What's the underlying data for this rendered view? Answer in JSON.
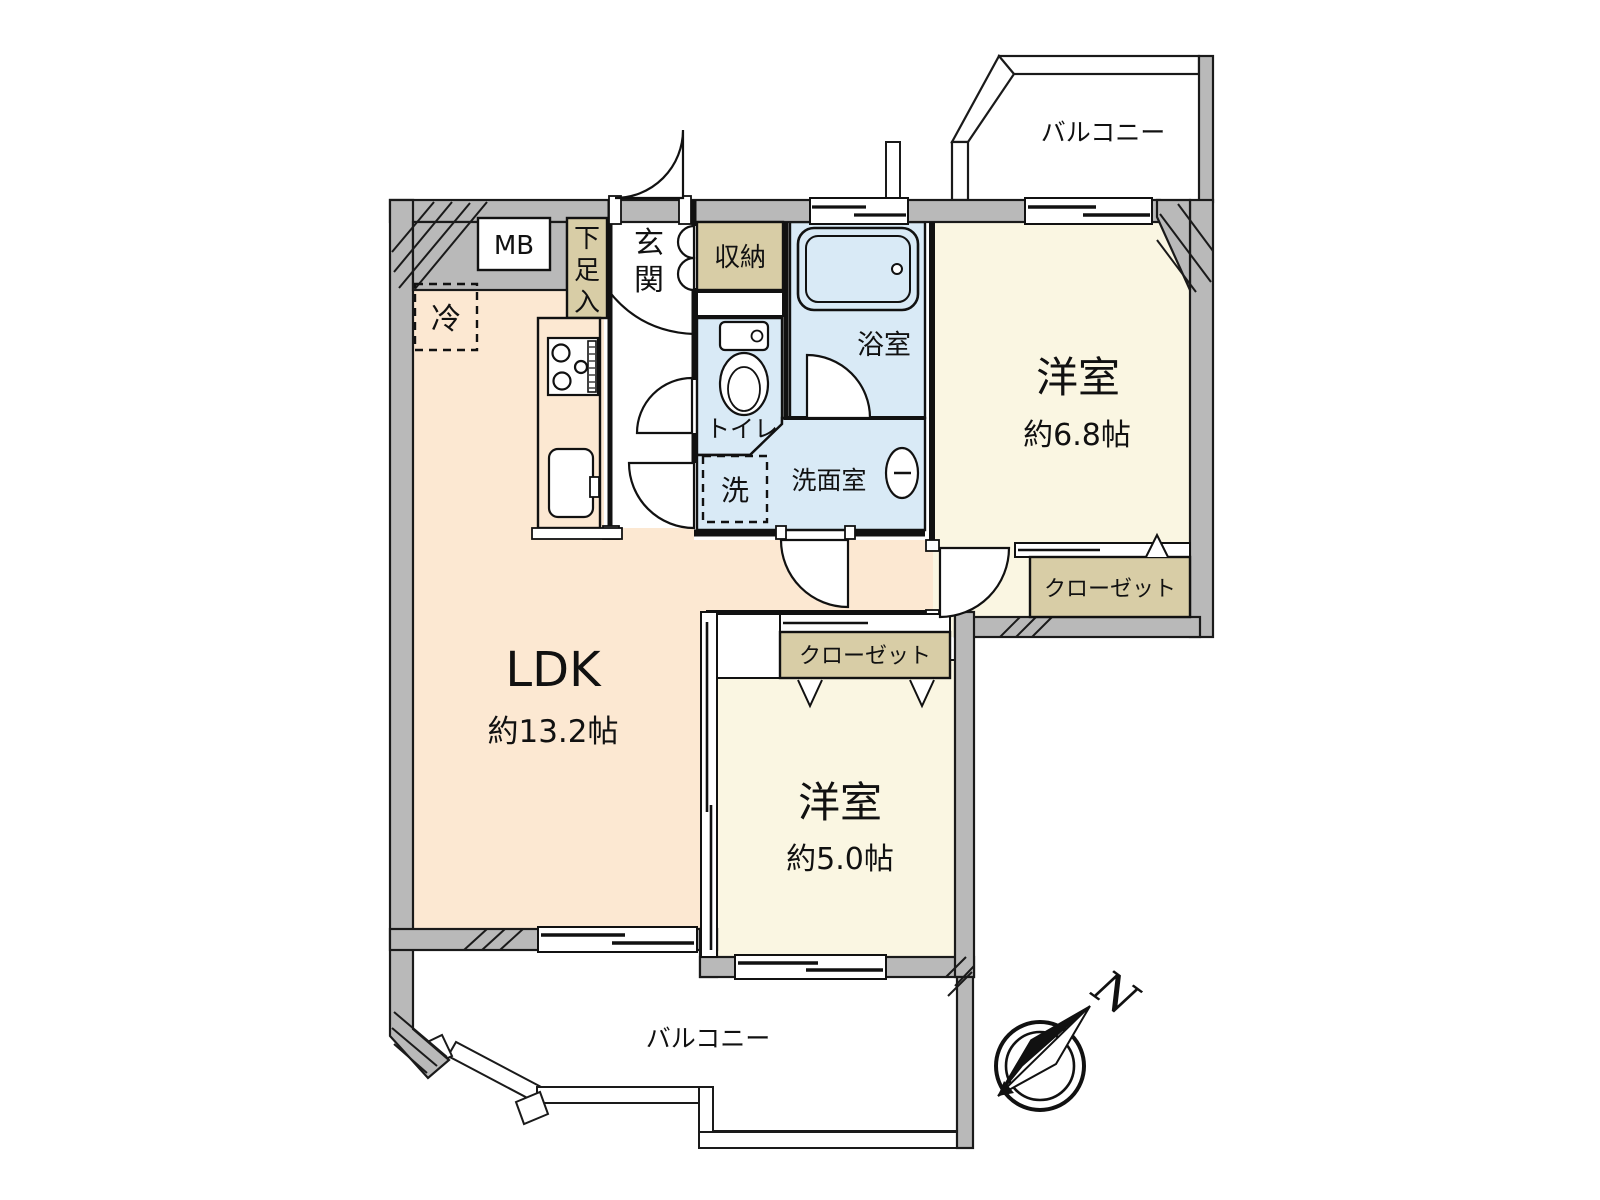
{
  "floorplan": {
    "labels": {
      "balcony_top": "バルコニー",
      "balcony_bottom": "バルコニー",
      "room_68_name": "洋室",
      "room_68_size": "約6.8帖",
      "room_50_name": "洋室",
      "room_50_size": "約5.0帖",
      "ldk_name": "LDK",
      "ldk_size": "約13.2帖",
      "bath": "浴室",
      "toilet": "トイレ",
      "washroom": "洗面室",
      "washer": "洗",
      "fridge": "冷",
      "meter_box": "MB",
      "genkan": "玄関",
      "shoe_box": "下足入",
      "storage": "収納",
      "closet_68": "クローゼット",
      "closet_50": "クローゼット",
      "compass_north": "N"
    },
    "colors": {
      "wall_gray": "#b9b9b9",
      "outline": "#1a1a1a",
      "ldk_floor": "#fce8d2",
      "room_floor": "#faf6e2",
      "wet_floor": "#d9eaf6",
      "closet_tan": "#d8cda6",
      "white": "#ffffff"
    }
  }
}
